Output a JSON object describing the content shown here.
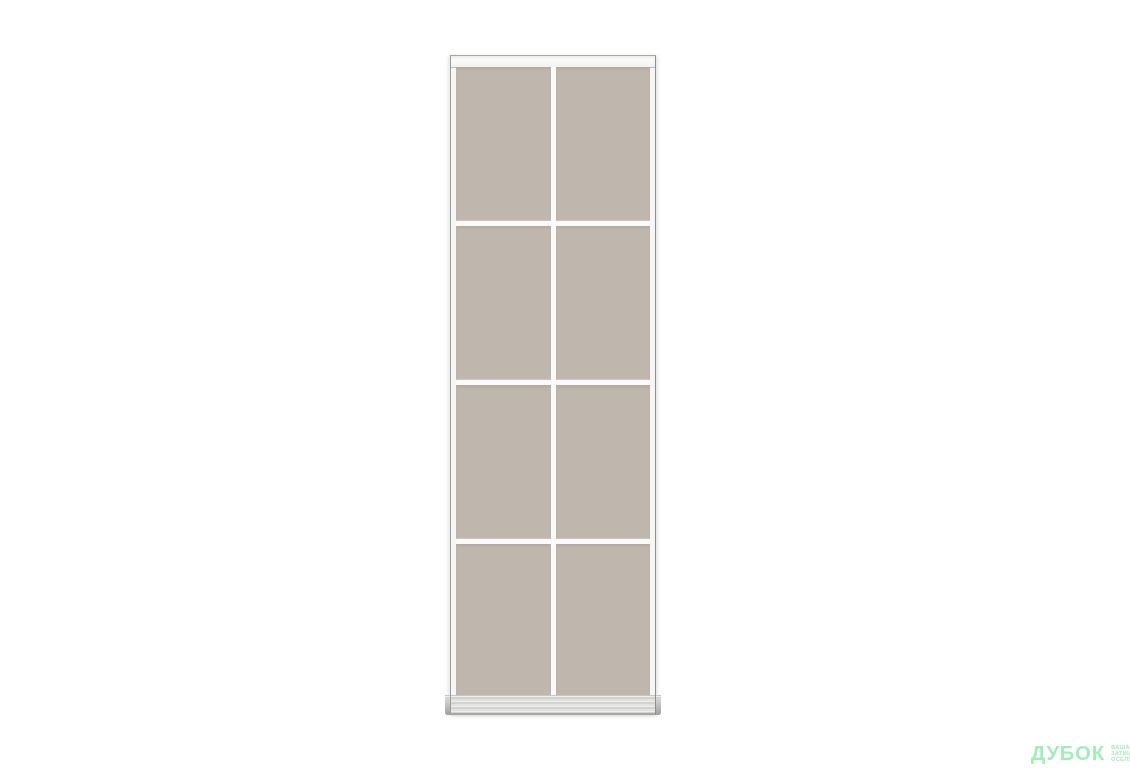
{
  "scene": {
    "description": "Sliding wardrobe door panel with aluminum white frame and grid of beige-taupe glass inserts on white background",
    "door": {
      "grid_columns": 2,
      "grid_rows": 4,
      "pane_color": "#bfb6ad",
      "frame_color": "#f6f6f5",
      "frame_edge_color": "#9d9d9b",
      "mullion_color": "#fafaf9",
      "bottom_rail_color": "#d2d2d0"
    }
  },
  "watermark": {
    "brand": "ДУБОК",
    "tagline_lines": [
      "ваша",
      "затишна",
      "оселя"
    ],
    "color": "#a3edba"
  }
}
